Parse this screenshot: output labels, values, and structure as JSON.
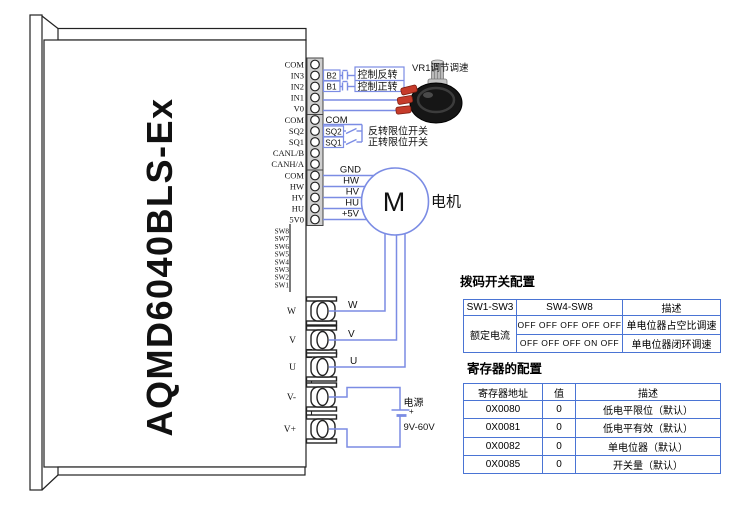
{
  "device": {
    "model": "AQMD6040BLS-Ex",
    "pins": [
      "COM",
      "IN3",
      "IN2",
      "IN1",
      "V0",
      "COM",
      "SQ2",
      "SQ1",
      "CANL/B",
      "CANH/A",
      "COM",
      "HW",
      "HV",
      "HU",
      "5V0"
    ],
    "dip_labels": [
      "SW8",
      "SW7",
      "SW6",
      "SW5",
      "SW4",
      "SW3",
      "SW2",
      "SW1"
    ],
    "terminals": [
      "W",
      "V",
      "U",
      "V-",
      "V+"
    ]
  },
  "wiring": {
    "buttons": [
      {
        "name": "B2",
        "desc": "控制反转"
      },
      {
        "name": "B1",
        "desc": "控制正转"
      }
    ],
    "com_label": "COM",
    "limit_switches": [
      {
        "name": "SQ2",
        "desc": "反转限位开关"
      },
      {
        "name": "SQ1",
        "desc": "正转限位开关"
      }
    ],
    "pot_label": "VR1调节调速",
    "hall_wires": [
      "GND",
      "HW",
      "HV",
      "HU",
      "+5V"
    ],
    "motor": {
      "symbol": "M",
      "label": "电机"
    },
    "phase_wires": [
      "W",
      "V",
      "U"
    ],
    "power": {
      "label": "电源",
      "range": "9V-60V",
      "plus": "+"
    }
  },
  "tables": {
    "dip": {
      "title": "拨码开关配置",
      "headers": [
        "SW1-SW3",
        "SW4-SW8",
        "描述"
      ],
      "row_label": "额定电流",
      "rows": [
        {
          "sw48": "OFF OFF OFF OFF OFF",
          "desc": "单电位器占空比调速"
        },
        {
          "sw48": "OFF OFF OFF ON OFF",
          "desc": "单电位器闭环调速"
        }
      ]
    },
    "registers": {
      "title": "寄存器的配置",
      "headers": [
        "寄存器地址",
        "值",
        "描述"
      ],
      "rows": [
        {
          "addr": "0X0080",
          "val": "0",
          "desc": "低电平限位（默认）"
        },
        {
          "addr": "0X0081",
          "val": "0",
          "desc": "低电平有效（默认）"
        },
        {
          "addr": "0X0082",
          "val": "0",
          "desc": "单电位器（默认）"
        },
        {
          "addr": "0X0085",
          "val": "0",
          "desc": "开关量（默认）"
        }
      ]
    }
  },
  "colors": {
    "wire_blue": "#7b8ce4",
    "table_border_blue": "#4a74d4",
    "terminal_red": "#c63b2a",
    "outline_black": "#222222"
  }
}
